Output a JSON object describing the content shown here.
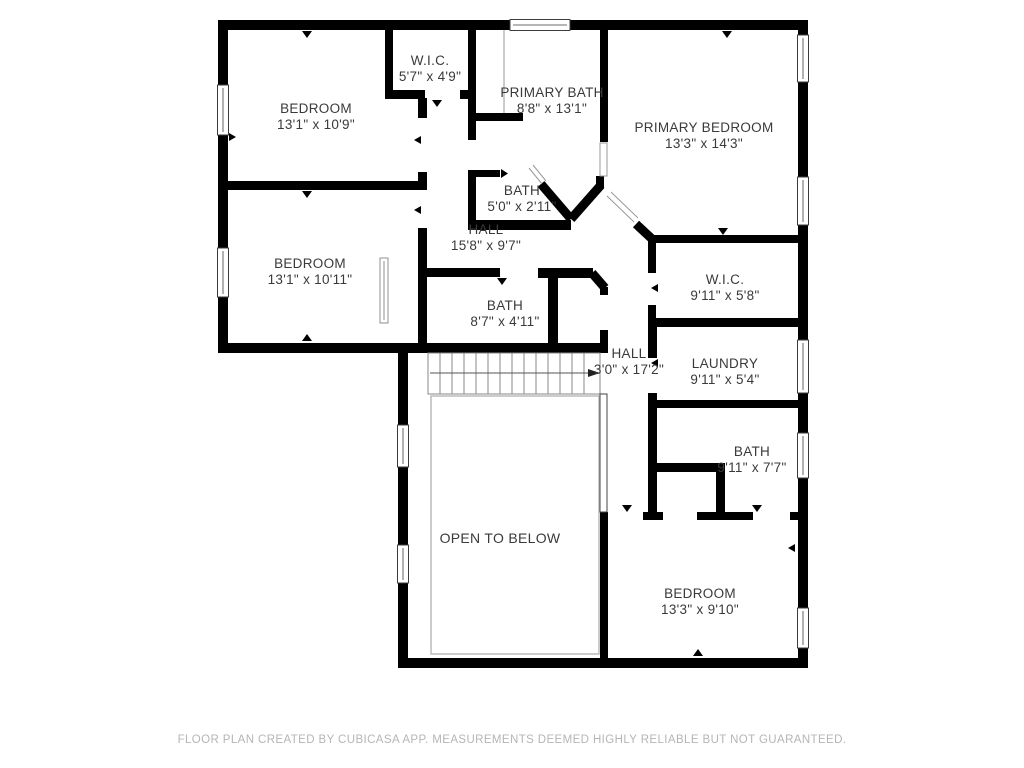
{
  "colors": {
    "background": "#ffffff",
    "wall": "#000000",
    "room_label": "#3a3a3a",
    "footer_text": "#b5b5b5"
  },
  "rooms": [
    {
      "name": "BEDROOM",
      "dims": "13'1\" x 10'9\""
    },
    {
      "name": "W.I.C.",
      "dims": "5'7\" x 4'9\""
    },
    {
      "name": "PRIMARY BATH",
      "dims": "8'8\" x 13'1\""
    },
    {
      "name": "PRIMARY BEDROOM",
      "dims": "13'3\" x 14'3\""
    },
    {
      "name": "BATH",
      "dims": "5'0\" x 2'11\""
    },
    {
      "name": "HALL",
      "dims": "15'8\" x 9'7\""
    },
    {
      "name": "BEDROOM",
      "dims": "13'1\" x 10'11\""
    },
    {
      "name": "W.I.C.",
      "dims": "9'11\" x 5'8\""
    },
    {
      "name": "BATH",
      "dims": "8'7\" x 4'11\""
    },
    {
      "name": "HALL",
      "dims": "3'0\" x 17'2\""
    },
    {
      "name": "LAUNDRY",
      "dims": "9'11\" x 5'4\""
    },
    {
      "name": "BATH",
      "dims": "9'11\" x 7'7\""
    },
    {
      "name": "OPEN TO BELOW",
      "dims": ""
    },
    {
      "name": "BEDROOM",
      "dims": "13'3\" x 9'10\""
    }
  ],
  "icons": {
    "stairs": "stairs-icon",
    "stair_direction_arrow": "stair-direction-arrow-icon",
    "window": "window-icon",
    "door_marker": "door-marker-icon",
    "railing": "railing-icon"
  },
  "footer": {
    "text": "FLOOR PLAN CREATED BY CUBICASA APP. MEASUREMENTS DEEMED HIGHLY RELIABLE BUT NOT GUARANTEED."
  }
}
